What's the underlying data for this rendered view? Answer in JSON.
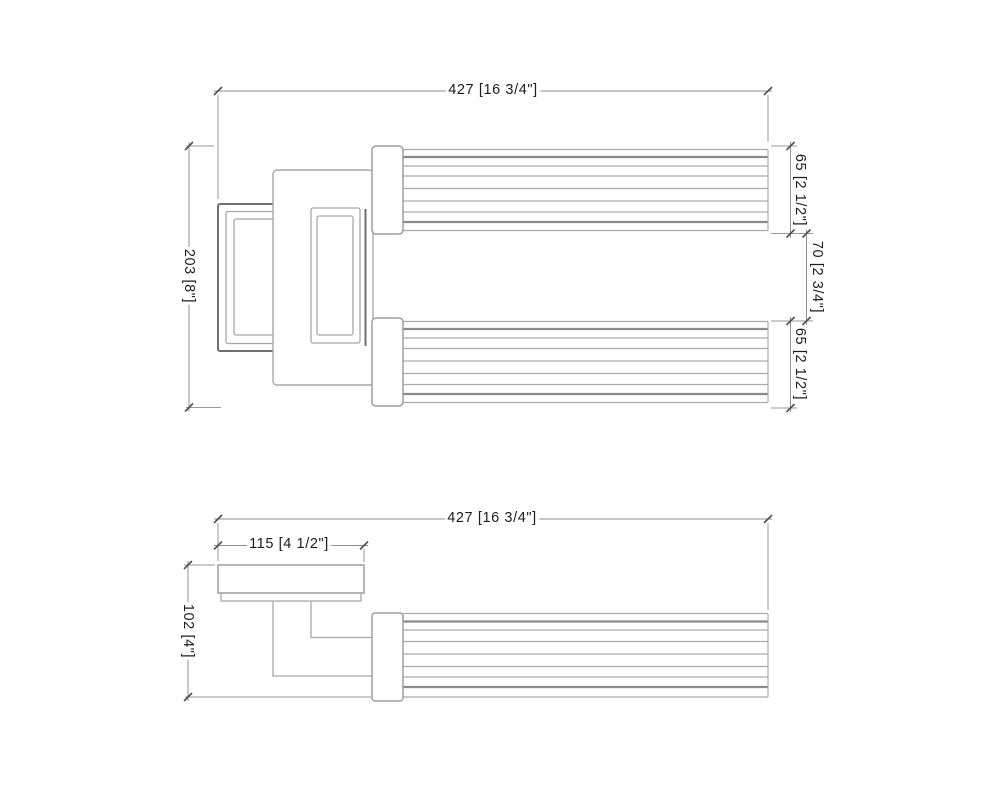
{
  "top_view": {
    "width": "427 [16 3/4\"]",
    "depth": "203 [8\"]",
    "bar_top": "65 [2 1/2\"]",
    "bar_gap": "70 [2 3/4\"]",
    "bar_bottom": "65 [2 1/2\"]"
  },
  "front_view": {
    "width": "427 [16 3/4\"]",
    "plate_width": "115 [4 1/2\"]",
    "height": "102 [4\"]"
  },
  "colors": {
    "background": "#ffffff",
    "line_light": "#a8a8a8",
    "line_dark": "#6f6f6f",
    "dim_line": "#8f8f8f",
    "tick": "#4f4f4f",
    "text": "#1c1c1c"
  }
}
